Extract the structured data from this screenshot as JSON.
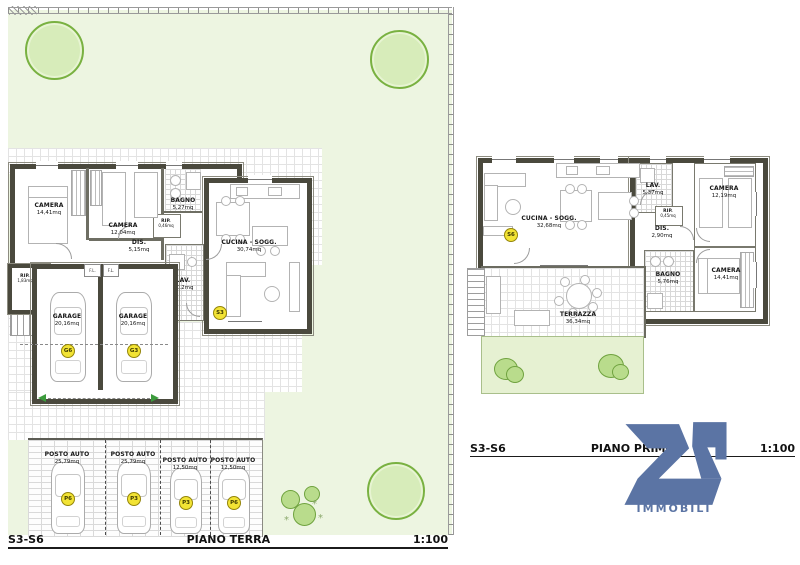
{
  "ground": {
    "title": {
      "sheet": "S3-S6",
      "name": "PIANO TERRA",
      "scale": "1:100"
    },
    "unit_marker": "S3",
    "fl_label": "F.L.",
    "rooms": [
      {
        "name": "CAMERA",
        "area": "14,41mq"
      },
      {
        "name": "CAMERA",
        "area": "12,04mq"
      },
      {
        "name": "BAGNO",
        "area": "5,27mq"
      },
      {
        "name": "RIP.",
        "area": "0,46mq"
      },
      {
        "name": "DIS.",
        "area": "5,15mq"
      },
      {
        "name": "LAV.",
        "area": "5,12mq"
      },
      {
        "name": "CUCINA - SOGG.",
        "area": "30,74mq"
      },
      {
        "name": "RIP.",
        "area": "1,83mq"
      }
    ],
    "garages": [
      {
        "name": "GARAGE",
        "area": "20,16mq",
        "code": "G6"
      },
      {
        "name": "GARAGE",
        "area": "20,16mq",
        "code": "G3"
      }
    ],
    "parking": [
      {
        "name": "POSTO AUTO",
        "area": "25,79mq",
        "code": "P6"
      },
      {
        "name": "POSTO AUTO",
        "area": "25,79mq",
        "code": "P3"
      },
      {
        "name": "POSTO AUTO",
        "area": "12,50mq",
        "code": "P3"
      },
      {
        "name": "POSTO AUTO",
        "area": "12,50mq",
        "code": "P6"
      }
    ]
  },
  "first": {
    "title": {
      "sheet": "S3-S6",
      "name": "PIANO PRIMO",
      "scale": "1:100"
    },
    "unit_marker": "S6",
    "rooms": [
      {
        "name": "CUCINA - SOGG.",
        "area": "32,68mq"
      },
      {
        "name": "LAV.",
        "area": "5,37mq"
      },
      {
        "name": "CAMERA",
        "area": "12,19mq"
      },
      {
        "name": "RIP.",
        "area": "0,45mq"
      },
      {
        "name": "DIS.",
        "area": "2,90mq"
      },
      {
        "name": "CAMERA",
        "area": "14,41mq"
      },
      {
        "name": "BAGNO",
        "area": "5,76mq"
      },
      {
        "name": "TERRAZZA",
        "area": "36,34mq"
      }
    ]
  },
  "logo": {
    "text": "IMMOBILI",
    "color": "#5b74a4"
  },
  "colors": {
    "marker_yellow": "#f2e334",
    "logo_blue": "#5b74a4",
    "lawn_green": "#edf5e1",
    "tree_green": "#79b141"
  }
}
